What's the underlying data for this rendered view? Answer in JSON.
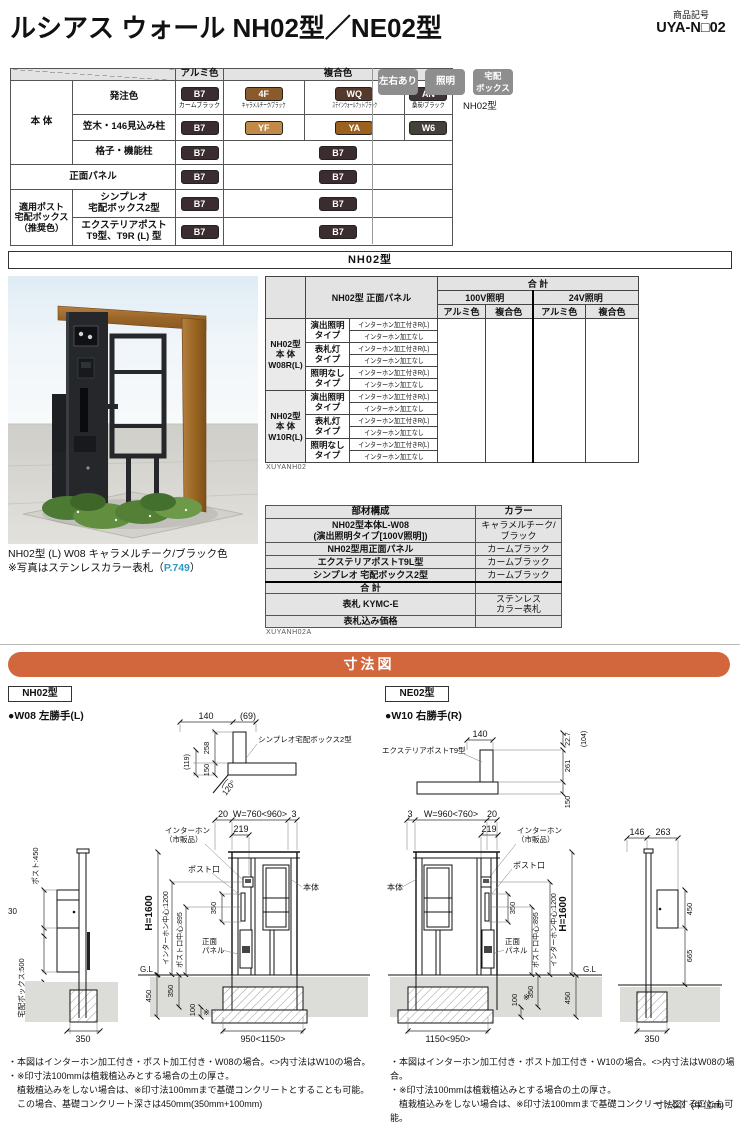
{
  "header": {
    "title": "ルシアス ウォール NH02型／NE02型",
    "code_label": "商品記号",
    "code_value": "UYA-N□02"
  },
  "badges": {
    "items": [
      "左右あり",
      "照明",
      "宅配\nボックス"
    ],
    "caption": "NH02型"
  },
  "color_table": {
    "alumi": "アルミ色",
    "fukugo": "複合色",
    "hontai": "本 体",
    "order_color": "発注色",
    "kasagi": "笠木・146見込み柱",
    "koshi": "格子・機能柱",
    "panel": "正面パネル",
    "post_group": "適用ポスト\n宅配ボックス\n（推奨色）",
    "simpleo": "シンプレオ\n宅配ボックス2型",
    "exterior": "エクステリアポスト\nT9型、T9R (L) 型",
    "chips": {
      "b7": {
        "code": "B7",
        "label": "カームブラック",
        "hex": "#3b2c30"
      },
      "f4": {
        "code": "4F",
        "label": "キャラメルチーク/ブラック",
        "hex": "#8a5a2c"
      },
      "wq": {
        "code": "WQ",
        "label": "ステインウォールナット/ブラック",
        "hex": "#55392b"
      },
      "an": {
        "code": "AN",
        "label": "桑炭/ブラック",
        "hex": "#3d3537"
      },
      "yf": {
        "code": "YF",
        "hex": "#c18a47"
      },
      "ya": {
        "code": "YA",
        "hex": "#9c611f"
      },
      "w6": {
        "code": "W6",
        "hex": "#454039"
      }
    }
  },
  "section_nh02": {
    "banner": "NH02型"
  },
  "photo": {
    "caption_line1": "NH02型 (L) W08 キャラメルチーク/ブラック色",
    "caption_line2_prefix": "※写真はステンレスカラー表札（",
    "caption_link": "P.749",
    "caption_line2_suffix": "）",
    "link_color": "#2b9bbf"
  },
  "price_table": {
    "head_panel": "NH02型 正面パネル",
    "head_total": "合 計",
    "head_100v": "100V照明",
    "head_24v": "24V照明",
    "head_alumi": "アルミ色",
    "head_fukugo": "複合色",
    "groups": [
      {
        "name": "NH02型\n本 体\nW08R(L)"
      },
      {
        "name": "NH02型\n本 体\nW10R(L)"
      }
    ],
    "types": [
      "演出照明\nタイプ",
      "表札灯\nタイプ",
      "照明なし\nタイプ"
    ],
    "opt_with": "インターホン加工付きR(L)",
    "opt_without": "インターホン加工なし",
    "code": "XUYANH02"
  },
  "component_table": {
    "head_name": "部材構成",
    "head_color": "カラー",
    "rows": [
      {
        "name": "NH02型本体L-W08\n(演出照明タイプ[100V照明])",
        "color": "キャラメルチーク/\nブラック"
      },
      {
        "name": "NH02型用正面パネル",
        "color": "カームブラック"
      },
      {
        "name": "エクステリアポストT9L型",
        "color": "カームブラック"
      },
      {
        "name": "シンプレオ 宅配ボックス2型",
        "color": "カームブラック"
      },
      {
        "name": "合 計",
        "color": ""
      },
      {
        "name": "表札 KYMC-E",
        "color": "ステンレス\nカラー表札"
      },
      {
        "name": "表札込み価格",
        "color": ""
      }
    ],
    "code": "XUYANH02A"
  },
  "dimension_section": {
    "banner": "寸法図",
    "unit_note": "寸法図：(単位㎜)",
    "left_model": "NH02型",
    "right_model": "NE02型",
    "left_variant": "●W08 左勝手(L)",
    "right_variant": "●W10 右勝手(R)",
    "banner_color": "#d2673e"
  },
  "diagram_nh": {
    "d140": "140",
    "d69": "(69)",
    "box_label": "シンプレオ宅配ボックス2型",
    "d119": "(119)",
    "d150": "150",
    "d258": "258",
    "angle": "120°",
    "d20": "20",
    "dw": "W=760<960>",
    "d3": "3",
    "d219": "219",
    "intercom1": "インターホン",
    "intercom2": "（市販品）",
    "post_slot": "ポスト口",
    "hontai": "本体",
    "h": "H=1600",
    "ic_center": "インターホン中心:1200",
    "slot_center": "ポスト口中心:895",
    "d350": "350",
    "panel1": "正面",
    "panel2": "パネル",
    "gl": "G.L",
    "g450": "450",
    "g350": "350",
    "g100": "100",
    "star": "※",
    "gw": "950<1150>",
    "side_post": "ポスト:450",
    "side_30": "30",
    "side_box": "宅配ボックス:500",
    "side_135": "135",
    "side_350": "350"
  },
  "diagram_ne": {
    "d140": "140",
    "d227": "22.7",
    "d104": "(104)",
    "box_label": "エクステリアポストT9型",
    "d261": "261",
    "d150": "150",
    "d3": "3",
    "dw": "W=960<760>",
    "d20": "20",
    "d219": "219",
    "intercom1": "インターホン",
    "intercom2": "（市販品）",
    "post_slot": "ポスト口",
    "hontai": "本体",
    "h": "H=1600",
    "ic_center": "インターホン中心:1200",
    "slot_center": "ポスト口中心:895",
    "d350": "350",
    "panel1": "正面",
    "panel2": "パネル",
    "gl": "G.L",
    "g450": "450",
    "g350": "350",
    "g100": "100",
    "star": "※",
    "gw": "1150<950>",
    "side_146": "146",
    "side_263": "263",
    "side_450": "450",
    "side_665": "665",
    "side_350": "350"
  },
  "notes_left": {
    "l1": "・本図はインターホン加工付き・ポスト加工付き・W08の場合。<>内寸法はW10の場合。",
    "l2": "・※印寸法100mmは植栽植込みとする場合の土の厚さ。",
    "l3": "　植栽植込みをしない場合は、※印寸法100mmまで基礎コンクリートとすることも可能。",
    "l4": "　この場合、基礎コンクリート深さは450mm(350mm+100mm)"
  },
  "notes_right": {
    "l1": "・本図はインターホン加工付き・ポスト加工付き・W10の場合。<>内寸法はW08の場合。",
    "l2": "・※印寸法100mmは植栽植込みとする場合の土の厚さ。",
    "l3": "　植栽植込みをしない場合は、※印寸法100mmまで基礎コンクリートとすることも可能。",
    "l4": "　この場合、基礎コンクリート深さは450mm(350mm+100mm)"
  }
}
